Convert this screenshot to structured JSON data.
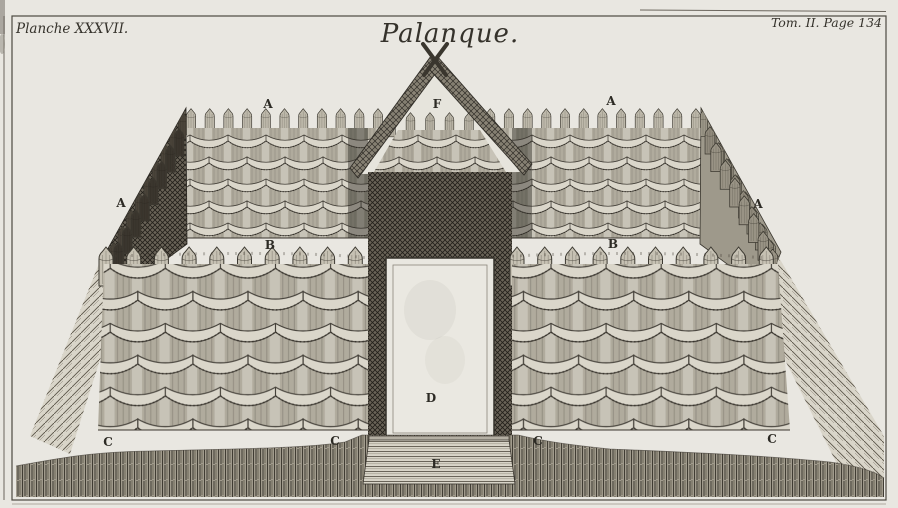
{
  "page": {
    "background": "#e9e7e1",
    "ink": "#35322b",
    "description": "Engraved book plate: perspective view of a wattle palisade fort (palanque) with roofed gateway"
  },
  "captions": {
    "plate_number": "Planche XXXVII.",
    "title": "Palanque.",
    "tome_page": "Tom. II. Page 134"
  },
  "figure": {
    "markers": {
      "a": "A",
      "b": "B",
      "c": "C",
      "d": "D",
      "e": "E",
      "f": "F"
    }
  }
}
